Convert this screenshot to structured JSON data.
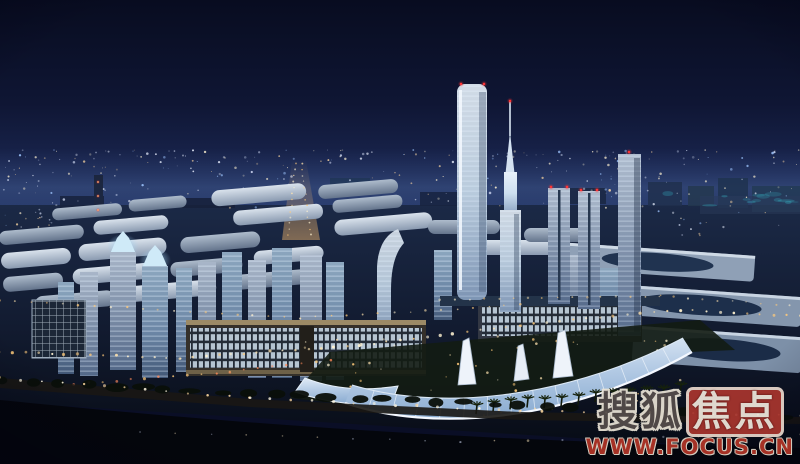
{
  "watermark": {
    "brand_part1": "搜狐",
    "brand_part2": "焦点",
    "url": "WWW.FOCUS.CN"
  },
  "palette": {
    "sky_top": "#080c20",
    "sky_horizon": "#283b6e",
    "city_glow": "#31497c",
    "tower_glass": "#d9e6f4",
    "hall_roof": "#b7c4d4",
    "canopy_glass": "#b7cde6",
    "slab_frame": "#9c8a66",
    "warm_light": "#ffca7a",
    "beacon_red": "#ff3434",
    "watermark_red": "#a8352e"
  }
}
